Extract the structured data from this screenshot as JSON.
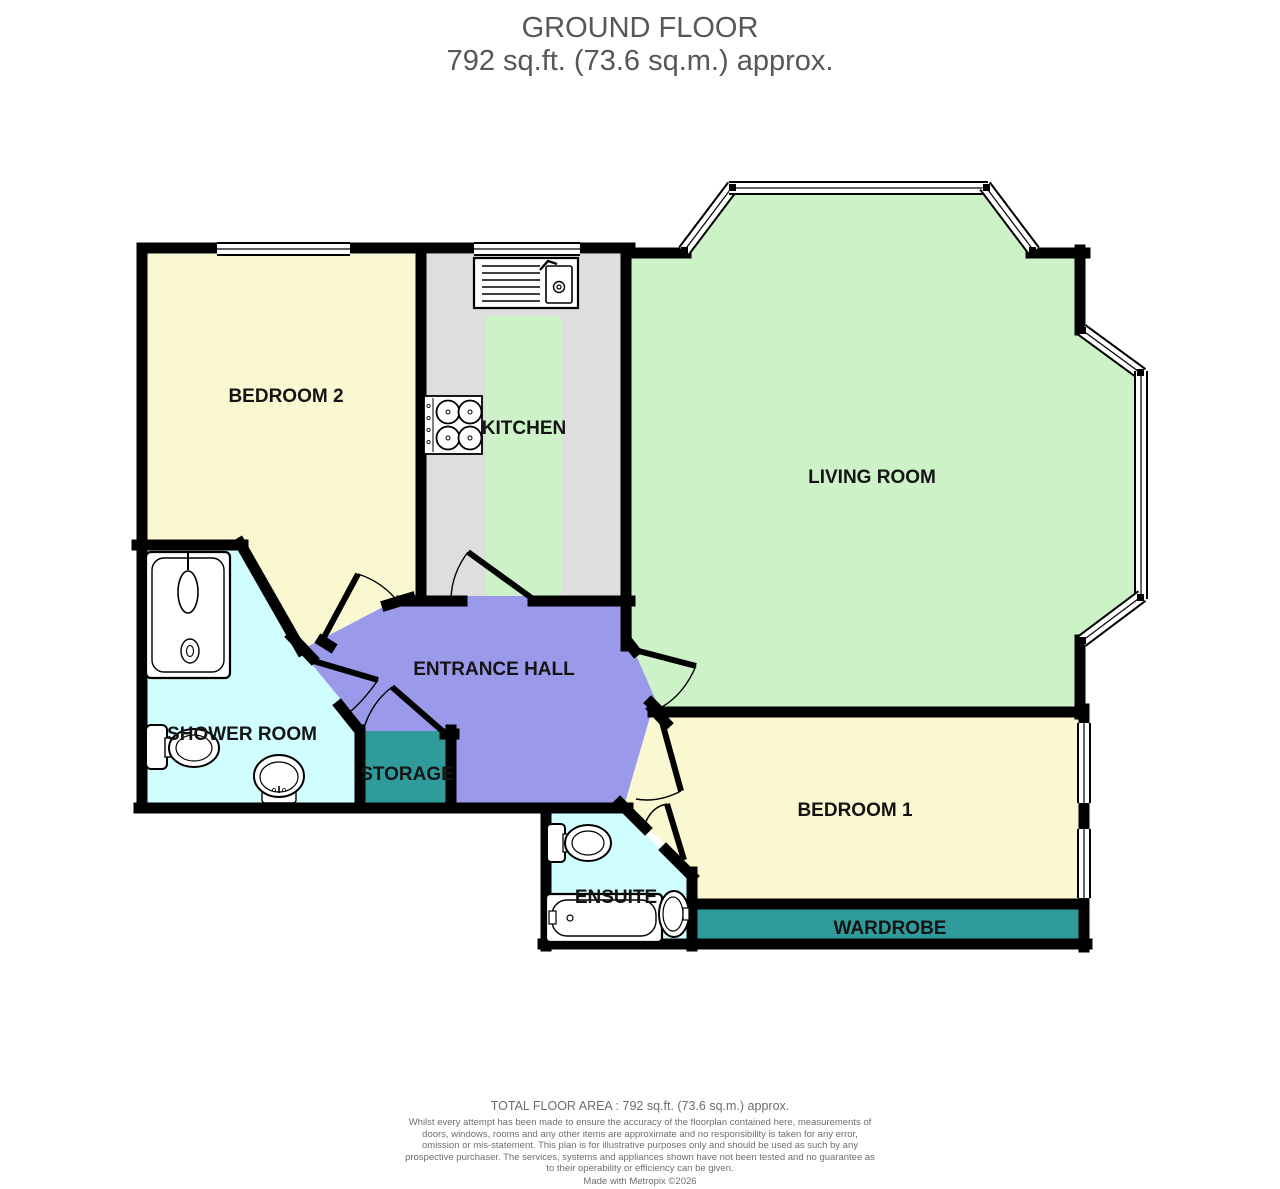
{
  "title": {
    "line1": "GROUND FLOOR",
    "line2": "792 sq.ft. (73.6 sq.m.) approx."
  },
  "rooms": {
    "bedroom2": "BEDROOM 2",
    "kitchen": "KITCHEN",
    "living_room": "LIVING ROOM",
    "entrance_hall": "ENTRANCE HALL",
    "shower_room": "SHOWER ROOM",
    "storage": "STORAGE",
    "bedroom1": "BEDROOM 1",
    "wardrobe": "WARDROBE",
    "ensuite": "ENSUITE"
  },
  "colors": {
    "room_yellow": "#FAF8D0",
    "room_green": "#CDF2C8",
    "room_grey": "#DEDEDE",
    "room_purple": "#9B99EA",
    "room_cyan": "#D0FDFE",
    "room_teal": "#2F9B9B",
    "wall": "#000000",
    "title_text": "#575757",
    "footer_text": "#6E6E6E"
  },
  "footer": {
    "total": "TOTAL FLOOR AREA : 792 sq.ft. (73.6 sq.m.) approx.",
    "disclaimer": "Whilst every attempt has been made to ensure the accuracy of the floorplan contained here, measurements of doors, windows, rooms and any other items are approximate and no responsibility is taken for any error, omission or mis-statement. This plan is for illustrative purposes only and should be used as such by any prospective purchaser. The services, systems and appliances shown have not been tested and no guarantee as to their operability or efficiency can be given.",
    "made_with": "Made with Metropix ©2026"
  }
}
